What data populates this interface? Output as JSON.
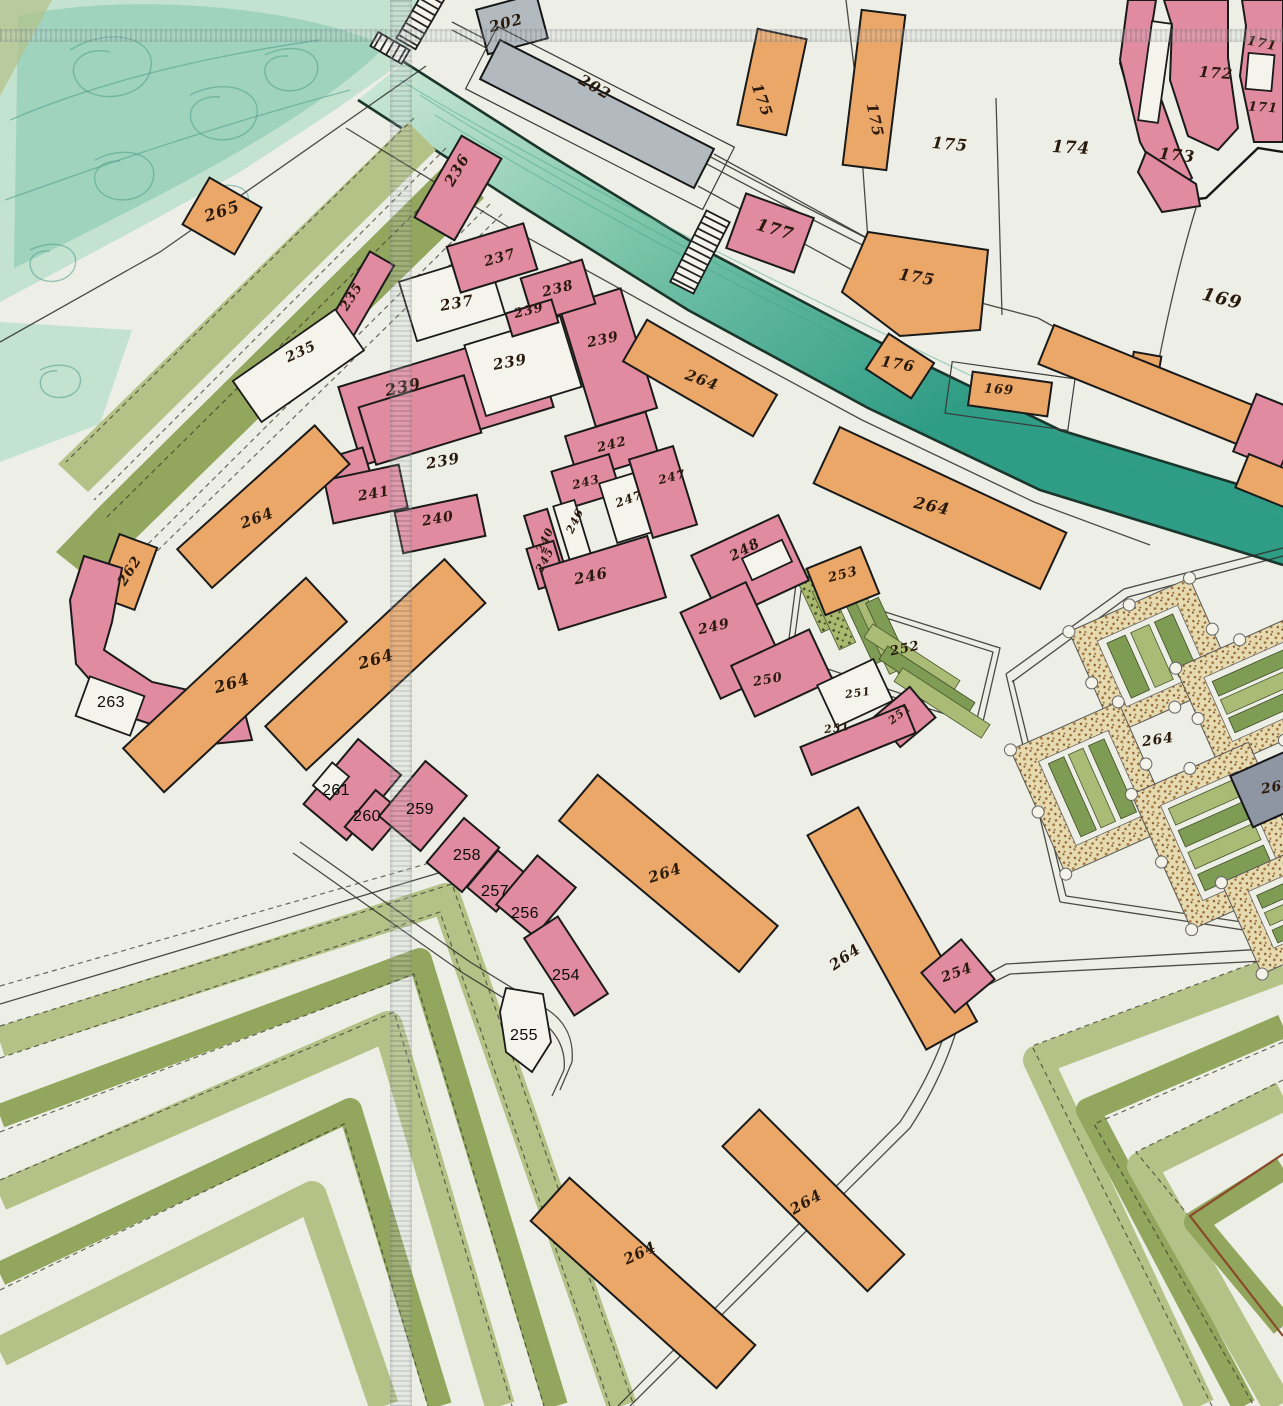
{
  "meta": {
    "width": 1283,
    "height": 1406
  },
  "palette": {
    "paper": "#edefe6",
    "water": "#c3e2d0",
    "waterDeep": "#7cc4ab",
    "canalDark": "#1b352b",
    "canalMid": "#3fa18a",
    "pink": "#e18ba1",
    "orange": "#eaa768",
    "bldgWhite": "#f4f4ec",
    "grey": "#b3babf",
    "slate": "#8e96a4",
    "rampPale": "#b5c287",
    "rampMid": "#92a65d",
    "bedGreen": "#7f9c55",
    "bedGreen2": "#a9bb75",
    "borderBeige": "#e6dab0",
    "ink": "#2a1a0c",
    "lineDark": "#2e2d28",
    "brown": "#8a4a2a"
  },
  "labels": {
    "handwritten": [
      {
        "text": "202",
        "x": 506,
        "y": 23,
        "rot": -15,
        "size": 15
      },
      {
        "text": "202",
        "x": 595,
        "y": 87,
        "rot": 30,
        "size": 15
      },
      {
        "text": "265",
        "x": 222,
        "y": 211,
        "rot": -18,
        "size": 16
      },
      {
        "text": "236",
        "x": 457,
        "y": 170,
        "rot": -60,
        "size": 15
      },
      {
        "text": "175",
        "x": 762,
        "y": 100,
        "rot": 70,
        "size": 15
      },
      {
        "text": "175",
        "x": 875,
        "y": 120,
        "rot": 78,
        "size": 15
      },
      {
        "text": "175",
        "x": 950,
        "y": 144,
        "rot": 5,
        "size": 16
      },
      {
        "text": "174",
        "x": 1071,
        "y": 148,
        "rot": 3,
        "size": 17
      },
      {
        "text": "172",
        "x": 1216,
        "y": 73,
        "rot": 4,
        "size": 15
      },
      {
        "text": "171",
        "x": 1262,
        "y": 44,
        "rot": 12,
        "size": 13
      },
      {
        "text": "171",
        "x": 1263,
        "y": 108,
        "rot": 4,
        "size": 13
      },
      {
        "text": "173",
        "x": 1177,
        "y": 155,
        "rot": 6,
        "size": 16
      },
      {
        "text": "177",
        "x": 775,
        "y": 230,
        "rot": 16,
        "size": 17
      },
      {
        "text": "175",
        "x": 917,
        "y": 277,
        "rot": 10,
        "size": 16
      },
      {
        "text": "176",
        "x": 898,
        "y": 364,
        "rot": 10,
        "size": 15
      },
      {
        "text": "169",
        "x": 999,
        "y": 390,
        "rot": 4,
        "size": 13
      },
      {
        "text": "169",
        "x": 1222,
        "y": 299,
        "rot": 14,
        "size": 18
      },
      {
        "text": "237",
        "x": 500,
        "y": 258,
        "rot": -16,
        "size": 14
      },
      {
        "text": "237",
        "x": 457,
        "y": 303,
        "rot": -10,
        "size": 15
      },
      {
        "text": "238",
        "x": 558,
        "y": 289,
        "rot": -14,
        "size": 14
      },
      {
        "text": "239",
        "x": 529,
        "y": 311,
        "rot": -14,
        "size": 13
      },
      {
        "text": "239",
        "x": 603,
        "y": 340,
        "rot": -12,
        "size": 14
      },
      {
        "text": "239",
        "x": 510,
        "y": 362,
        "rot": -10,
        "size": 15
      },
      {
        "text": "239",
        "x": 403,
        "y": 387,
        "rot": -12,
        "size": 16
      },
      {
        "text": "239",
        "x": 443,
        "y": 461,
        "rot": -10,
        "size": 15
      },
      {
        "text": "235",
        "x": 352,
        "y": 297,
        "rot": -58,
        "size": 13
      },
      {
        "text": "235",
        "x": 301,
        "y": 352,
        "rot": -25,
        "size": 14
      },
      {
        "text": "241",
        "x": 374,
        "y": 494,
        "rot": -10,
        "size": 14
      },
      {
        "text": "240",
        "x": 438,
        "y": 519,
        "rot": -10,
        "size": 14
      },
      {
        "text": "242",
        "x": 612,
        "y": 445,
        "rot": -14,
        "size": 13
      },
      {
        "text": "243",
        "x": 586,
        "y": 482,
        "rot": -14,
        "size": 12
      },
      {
        "text": "247",
        "x": 629,
        "y": 499,
        "rot": -20,
        "size": 12
      },
      {
        "text": "247",
        "x": 672,
        "y": 477,
        "rot": -14,
        "size": 12
      },
      {
        "text": "240",
        "x": 545,
        "y": 540,
        "rot": -65,
        "size": 11
      },
      {
        "text": "246",
        "x": 575,
        "y": 521,
        "rot": -65,
        "size": 11
      },
      {
        "text": "245",
        "x": 545,
        "y": 560,
        "rot": -62,
        "size": 11
      },
      {
        "text": "246",
        "x": 591,
        "y": 576,
        "rot": -12,
        "size": 15
      },
      {
        "text": "248",
        "x": 745,
        "y": 550,
        "rot": -28,
        "size": 14
      },
      {
        "text": "253",
        "x": 843,
        "y": 575,
        "rot": -14,
        "size": 13
      },
      {
        "text": "252",
        "x": 905,
        "y": 649,
        "rot": -12,
        "size": 13
      },
      {
        "text": "249",
        "x": 714,
        "y": 627,
        "rot": -12,
        "size": 14
      },
      {
        "text": "250",
        "x": 768,
        "y": 680,
        "rot": -10,
        "size": 13
      },
      {
        "text": "251",
        "x": 858,
        "y": 693,
        "rot": -8,
        "size": 11
      },
      {
        "text": "251",
        "x": 900,
        "y": 714,
        "rot": -38,
        "size": 11
      },
      {
        "text": "251",
        "x": 837,
        "y": 728,
        "rot": -8,
        "size": 11
      },
      {
        "text": "264",
        "x": 257,
        "y": 518,
        "rot": -20,
        "size": 15
      },
      {
        "text": "264",
        "x": 232,
        "y": 683,
        "rot": -16,
        "size": 16
      },
      {
        "text": "264",
        "x": 376,
        "y": 659,
        "rot": -16,
        "size": 16
      },
      {
        "text": "264",
        "x": 702,
        "y": 380,
        "rot": 20,
        "size": 15
      },
      {
        "text": "264",
        "x": 932,
        "y": 506,
        "rot": 12,
        "size": 16
      },
      {
        "text": "264",
        "x": 665,
        "y": 873,
        "rot": -18,
        "size": 15
      },
      {
        "text": "264",
        "x": 845,
        "y": 957,
        "rot": -35,
        "size": 15
      },
      {
        "text": "264",
        "x": 640,
        "y": 1253,
        "rot": -25,
        "size": 15
      },
      {
        "text": "264",
        "x": 806,
        "y": 1202,
        "rot": -30,
        "size": 15
      },
      {
        "text": "254",
        "x": 957,
        "y": 973,
        "rot": -20,
        "size": 14
      },
      {
        "text": "264",
        "x": 1158,
        "y": 740,
        "rot": -8,
        "size": 14
      },
      {
        "text": "264",
        "x": 1277,
        "y": 787,
        "rot": -10,
        "size": 14
      },
      {
        "text": "262",
        "x": 130,
        "y": 571,
        "rot": -58,
        "size": 14
      }
    ],
    "typed": [
      {
        "text": "263",
        "x": 111,
        "y": 703
      },
      {
        "text": "261",
        "x": 336,
        "y": 791
      },
      {
        "text": "260",
        "x": 367,
        "y": 817
      },
      {
        "text": "259",
        "x": 420,
        "y": 810
      },
      {
        "text": "258",
        "x": 467,
        "y": 856
      },
      {
        "text": "257",
        "x": 495,
        "y": 892
      },
      {
        "text": "256",
        "x": 525,
        "y": 914
      },
      {
        "text": "254",
        "x": 566,
        "y": 976
      },
      {
        "text": "255",
        "x": 524,
        "y": 1036
      }
    ]
  }
}
